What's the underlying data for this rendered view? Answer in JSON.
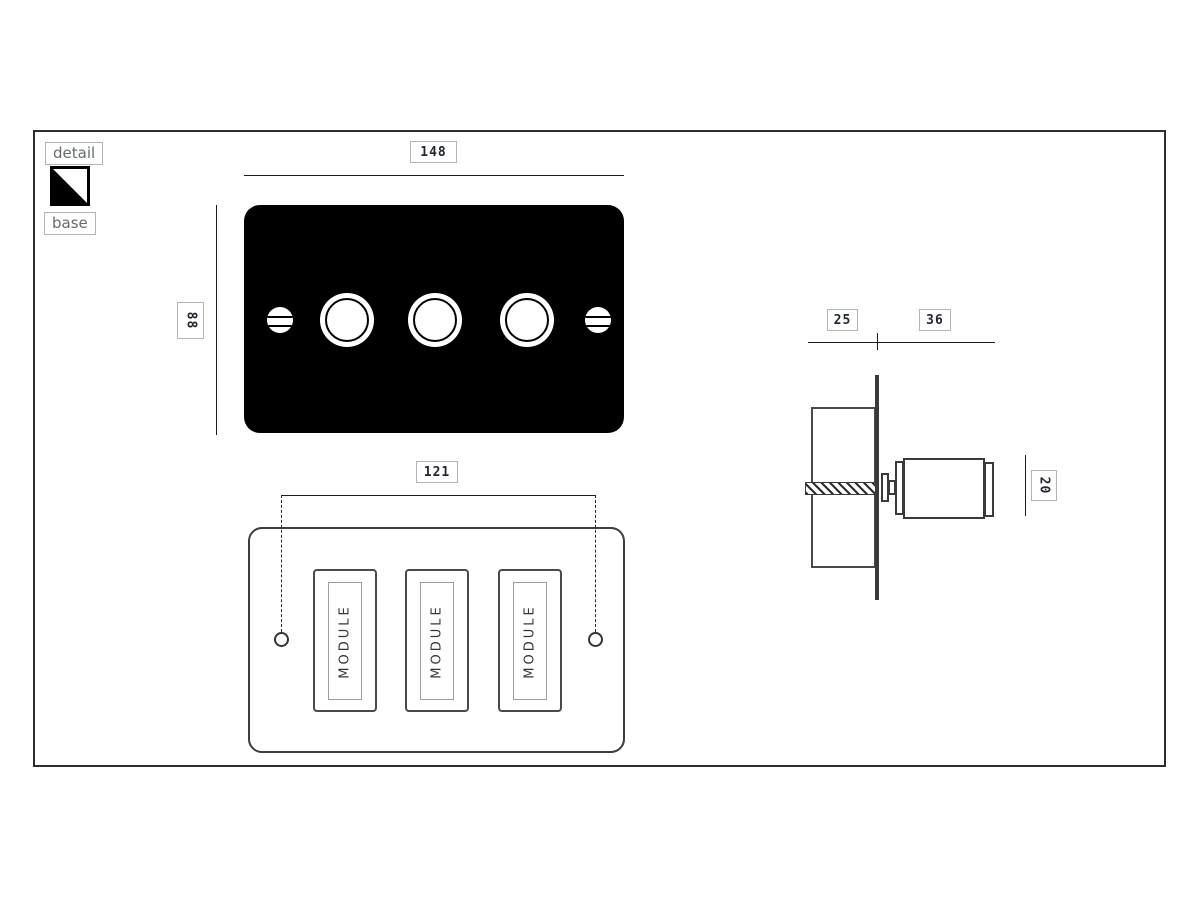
{
  "legend": {
    "detail_label": "detail",
    "base_label": "base",
    "detail_color": "#000000",
    "base_color": "#ffffff"
  },
  "colors": {
    "plate_fill": "#000000",
    "drawing_line": "#1c1c1c",
    "label_border": "#b4b4b4",
    "dim_text": "#232733"
  },
  "front_view": {
    "width_dim": "148",
    "height_dim": "88"
  },
  "rear_view": {
    "width_dim": "121",
    "modules": [
      "MODULE",
      "MODULE",
      "MODULE"
    ]
  },
  "side_view": {
    "box_depth_dim": "25",
    "knob_depth_dim": "36",
    "knob_height_dim": "20"
  }
}
